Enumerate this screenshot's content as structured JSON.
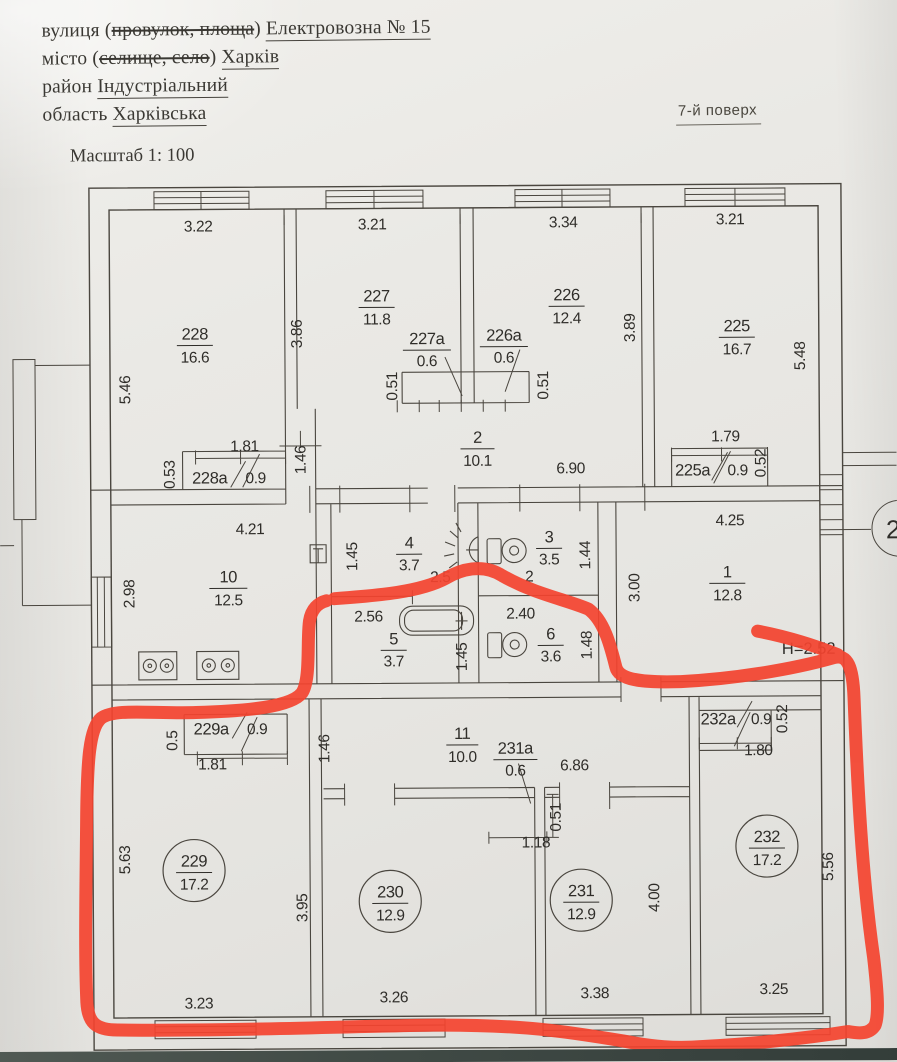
{
  "document": {
    "street_label": "вулиця (",
    "street_struck": "провулок, площа",
    "street_close": ")",
    "street_value": "Електровозна  № 15",
    "city_label": "місто (",
    "city_struck": "селище, село",
    "city_close": ")",
    "city_value": "Харків",
    "district_label": "район",
    "district_value": "Індустріальний",
    "region_label": "область",
    "region_value": "Харківська",
    "floor_note": "7-й поверх",
    "scale_note": "Масштаб 1: 100"
  },
  "plan": {
    "marker_color": "#f4432f",
    "ref_circle": "2",
    "height_note": "H=2.52",
    "rooms": {
      "r228": {
        "n": "228",
        "a": "16.6"
      },
      "r227": {
        "n": "227",
        "a": "11.8"
      },
      "r226": {
        "n": "226",
        "a": "12.4"
      },
      "r225": {
        "n": "225",
        "a": "16.7"
      },
      "r2": {
        "n": "2",
        "a": "10.1"
      },
      "r10": {
        "n": "10",
        "a": "12.5"
      },
      "r4": {
        "n": "4",
        "a": "3.7"
      },
      "r3": {
        "n": "3",
        "a": "3.5"
      },
      "r5": {
        "n": "5",
        "a": "3.7"
      },
      "r6": {
        "n": "6",
        "a": "3.6"
      },
      "r1": {
        "n": "1",
        "a": "12.8"
      },
      "r11": {
        "n": "11",
        "a": "10.0"
      },
      "r229": {
        "n": "229",
        "a": "17.2"
      },
      "r230": {
        "n": "230",
        "a": "12.9"
      },
      "r231": {
        "n": "231",
        "a": "12.9"
      },
      "r232": {
        "n": "232",
        "a": "17.2"
      },
      "c227a": {
        "n": "227a",
        "a": "0.6"
      },
      "c226a": {
        "n": "226a",
        "a": "0.6"
      },
      "c228a": {
        "n": "228a",
        "a": "0.9"
      },
      "c225a": {
        "n": "225a",
        "a": "0.9"
      },
      "c229a": {
        "n": "229a",
        "a": "0.9"
      },
      "c231a": {
        "n": "231a",
        "a": "0.6"
      },
      "c232a": {
        "n": "232a",
        "a": "0.9"
      }
    },
    "dims": {
      "t228": "3.22",
      "t227": "3.21",
      "t226": "3.34",
      "t225": "3.21",
      "l228": "5.46",
      "h227": "3.86",
      "h226": "3.89",
      "h225": "5.48",
      "w227a": "0.51",
      "w226a": "0.51",
      "d228a_w": "1.81",
      "d228a_h": "0.53",
      "corr2_l": "1.46",
      "corr2_w": "6.90",
      "d225a_w": "1.79",
      "d225a_h": "0.52",
      "k10_t": "4.21",
      "k10_l": "2.98",
      "r4_l": "1.45",
      "r4_w": "2.5",
      "r3_w": "2",
      "r3_r": "1.44",
      "r5_w": "2.56",
      "r5_r": "1.45",
      "r6_w": "2.40",
      "r6_r": "1.48",
      "r1_t": "4.25",
      "r1_l": "3.00",
      "corr11_l": "1.46",
      "corr11_w": "6.86",
      "d229a_w": "1.81",
      "d229a_h": "0.5",
      "d231a_h": "0.51",
      "d231a_w": "1.18",
      "d232a_w": "1.80",
      "d232a_h": "0.52",
      "l229": "5.63",
      "l230": "3.95",
      "r231v": "4.00",
      "r232v": "5.56",
      "b229": "3.23",
      "b230": "3.26",
      "b231": "3.38",
      "b232": "3.25"
    }
  }
}
